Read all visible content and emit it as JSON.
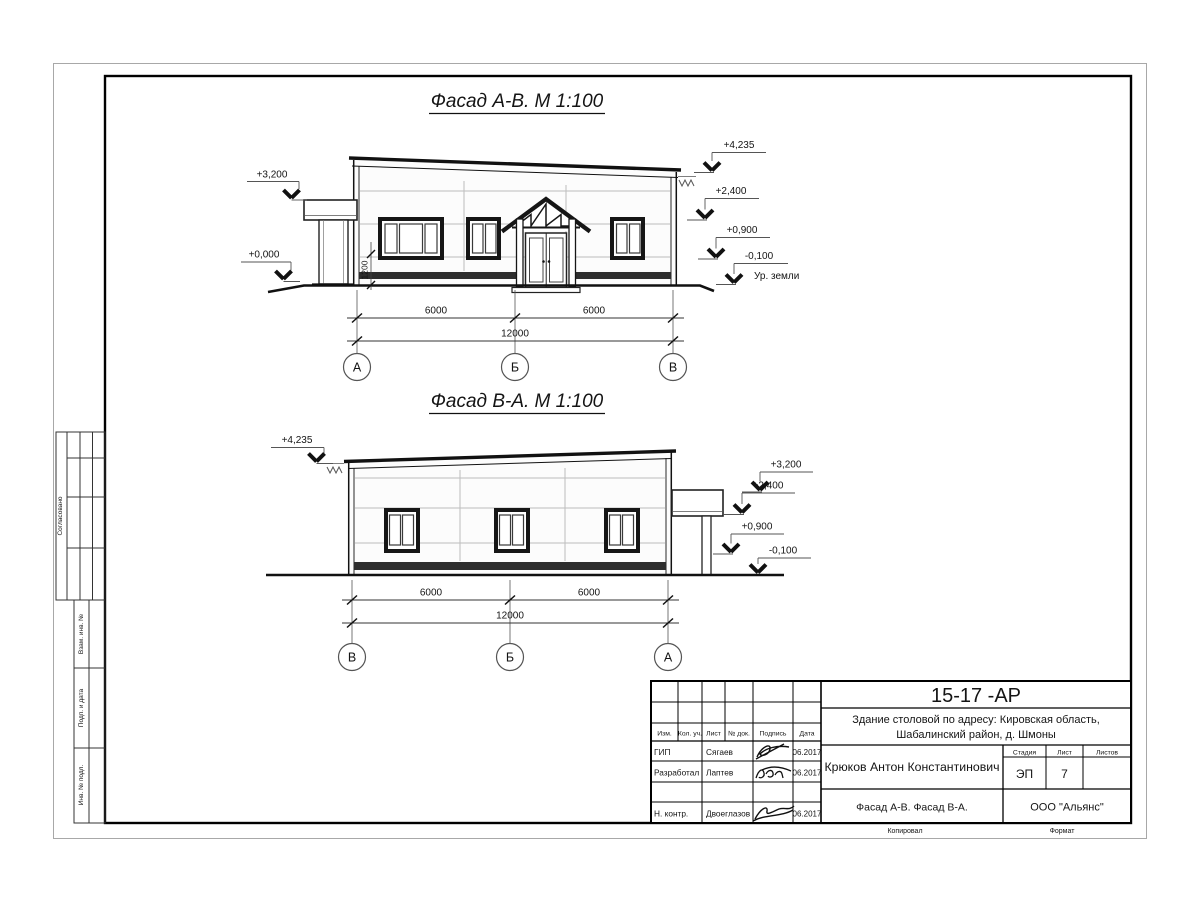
{
  "side_panel": {
    "approve": "Согласовано",
    "vzam": "Взам. инв. №",
    "podp": "Подп. и дата",
    "inv": "Инв. № подл."
  },
  "facade1": {
    "title": "Фасад А-В.  М 1:100",
    "marks": {
      "left_top": "+3,200",
      "left_bottom": "+0,000",
      "right_top": "+4,235",
      "right_2400": "+2,400",
      "right_0900": "+0,900",
      "right_minus": "-0,100"
    },
    "ground_label": "Ур. земли",
    "window_dim": "1200",
    "dims": {
      "left": "6000",
      "right": "6000",
      "total": "12000"
    },
    "axes": [
      "А",
      "Б",
      "В"
    ]
  },
  "facade2": {
    "title": "Фасад В-А.  М 1:100",
    "marks": {
      "left_top": "+4,235",
      "right_3200": "+3,200",
      "right_2400": "+2,400",
      "right_0900": "+0,900",
      "right_minus": "-0,100"
    },
    "dims": {
      "left": "6000",
      "right": "6000",
      "total": "12000"
    },
    "axes": [
      "В",
      "Б",
      "А"
    ]
  },
  "title_block": {
    "doc_number": "15-17 -АР",
    "object_line1": "Здание столовой по адресу: Кировская область,",
    "object_line2": "Шабалинский район, д. Шмоны",
    "columns": {
      "izm": "Изм.",
      "kol": "Кол. уч.",
      "list": "Лист",
      "doc": "№ док.",
      "sign": "Подпись",
      "date": "Дата"
    },
    "rows": [
      {
        "role": "ГИП",
        "name": "Сягаев",
        "date": "06.2017"
      },
      {
        "role": "Разработал",
        "name": "Лаптев",
        "date": "06.2017"
      },
      {
        "role": "Н. контр.",
        "name": "Двоеглазов",
        "date": "06.2017"
      }
    ],
    "author": "Крюков Антон Константинович",
    "stage_label": "Стадия",
    "sheet_label": "Лист",
    "sheets_label": "Листов",
    "stage": "ЭП",
    "sheet": "7",
    "sheets": "",
    "sheet_title": "Фасад А-В. Фасад В-А.",
    "company": "ООО \"Альянс\"",
    "copied_label": "Копировал",
    "format_label": "Формат"
  }
}
